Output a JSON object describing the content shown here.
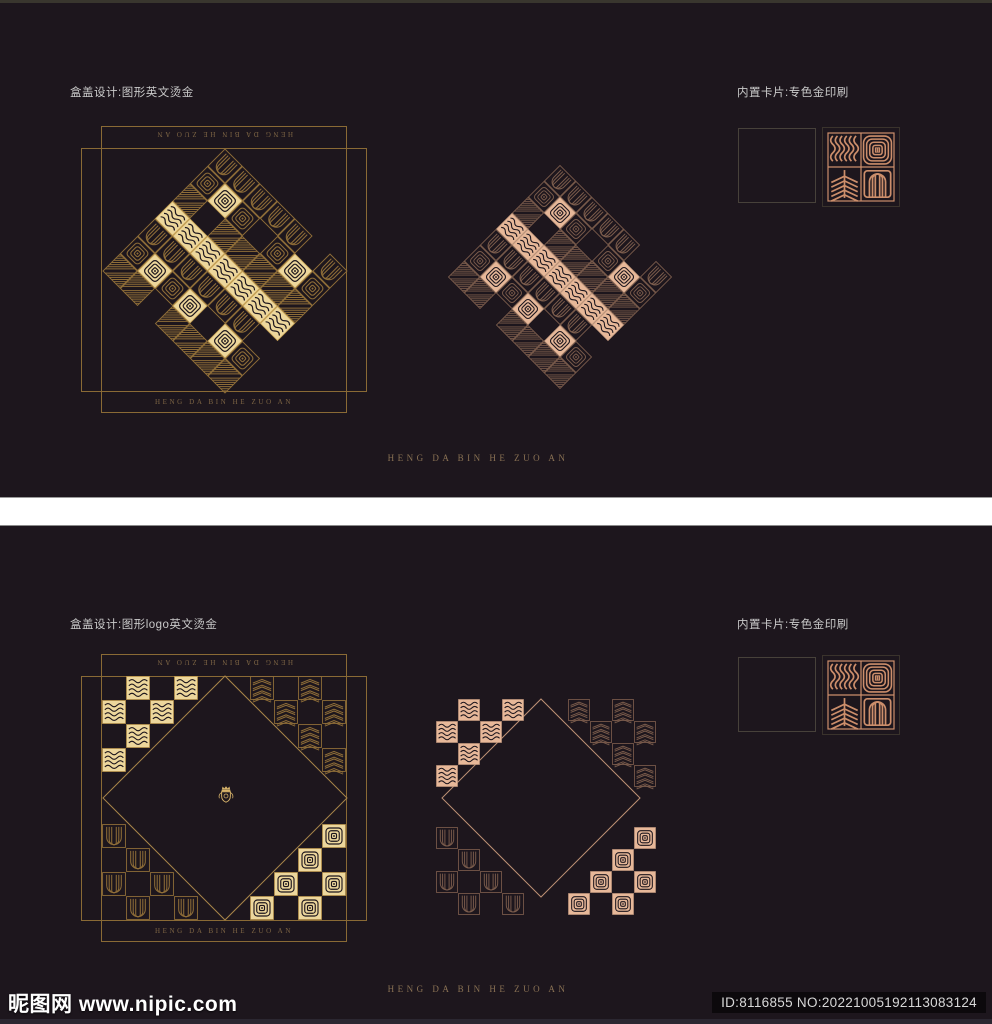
{
  "panel_top": {
    "label_left": "盒盖设计:图形英文烫金",
    "label_right": "内置卡片:专色金印刷",
    "brand_text": "HENG DA BIN HE ZUO AN",
    "frame_text": "HENG DA BIN HE ZUO AN"
  },
  "panel_bottom": {
    "label_left": "盒盖设计:图形logo英文烫金",
    "label_right": "内置卡片:专色金印刷",
    "brand_text": "HENG DA BIN HE ZUO AN",
    "frame_text": "HENG DA BIN HE ZUO AN"
  },
  "watermark": {
    "site_name": "昵图网",
    "site_url": "www.nipic.com",
    "id_text": "ID:8116855 NO:20221005192113083124"
  },
  "colors": {
    "panel_bg": "#1d161d",
    "divider": "#ffffff",
    "frame_stroke": "#8a6a35",
    "gold_fill": "#edd79c",
    "gold_frame": "#caa558",
    "gold_dim": "#8e6d38",
    "gold_diamond": "#a8854a",
    "gold_crest": "#d6b269",
    "copper_fill": "#e7b899",
    "copper_frame": "#c59b80",
    "copper_dim": "#7b5c4c",
    "copper_diamond": "#bd9175",
    "card_line": "#cc8e6b",
    "card_border": "#3a332c",
    "label_color": "#c9c9c9",
    "brand_color": "#8a7254"
  },
  "design": {
    "motif_cycle": [
      "wave",
      "stripes",
      "target",
      "arch"
    ],
    "cluster_cells": [
      [
        0,
        1
      ],
      [
        0,
        3
      ],
      [
        1,
        0
      ],
      [
        1,
        2
      ],
      [
        2,
        1
      ],
      [
        3,
        0
      ]
    ],
    "checker_radius": 6,
    "blank_mod": 9,
    "blank_val": 4
  }
}
